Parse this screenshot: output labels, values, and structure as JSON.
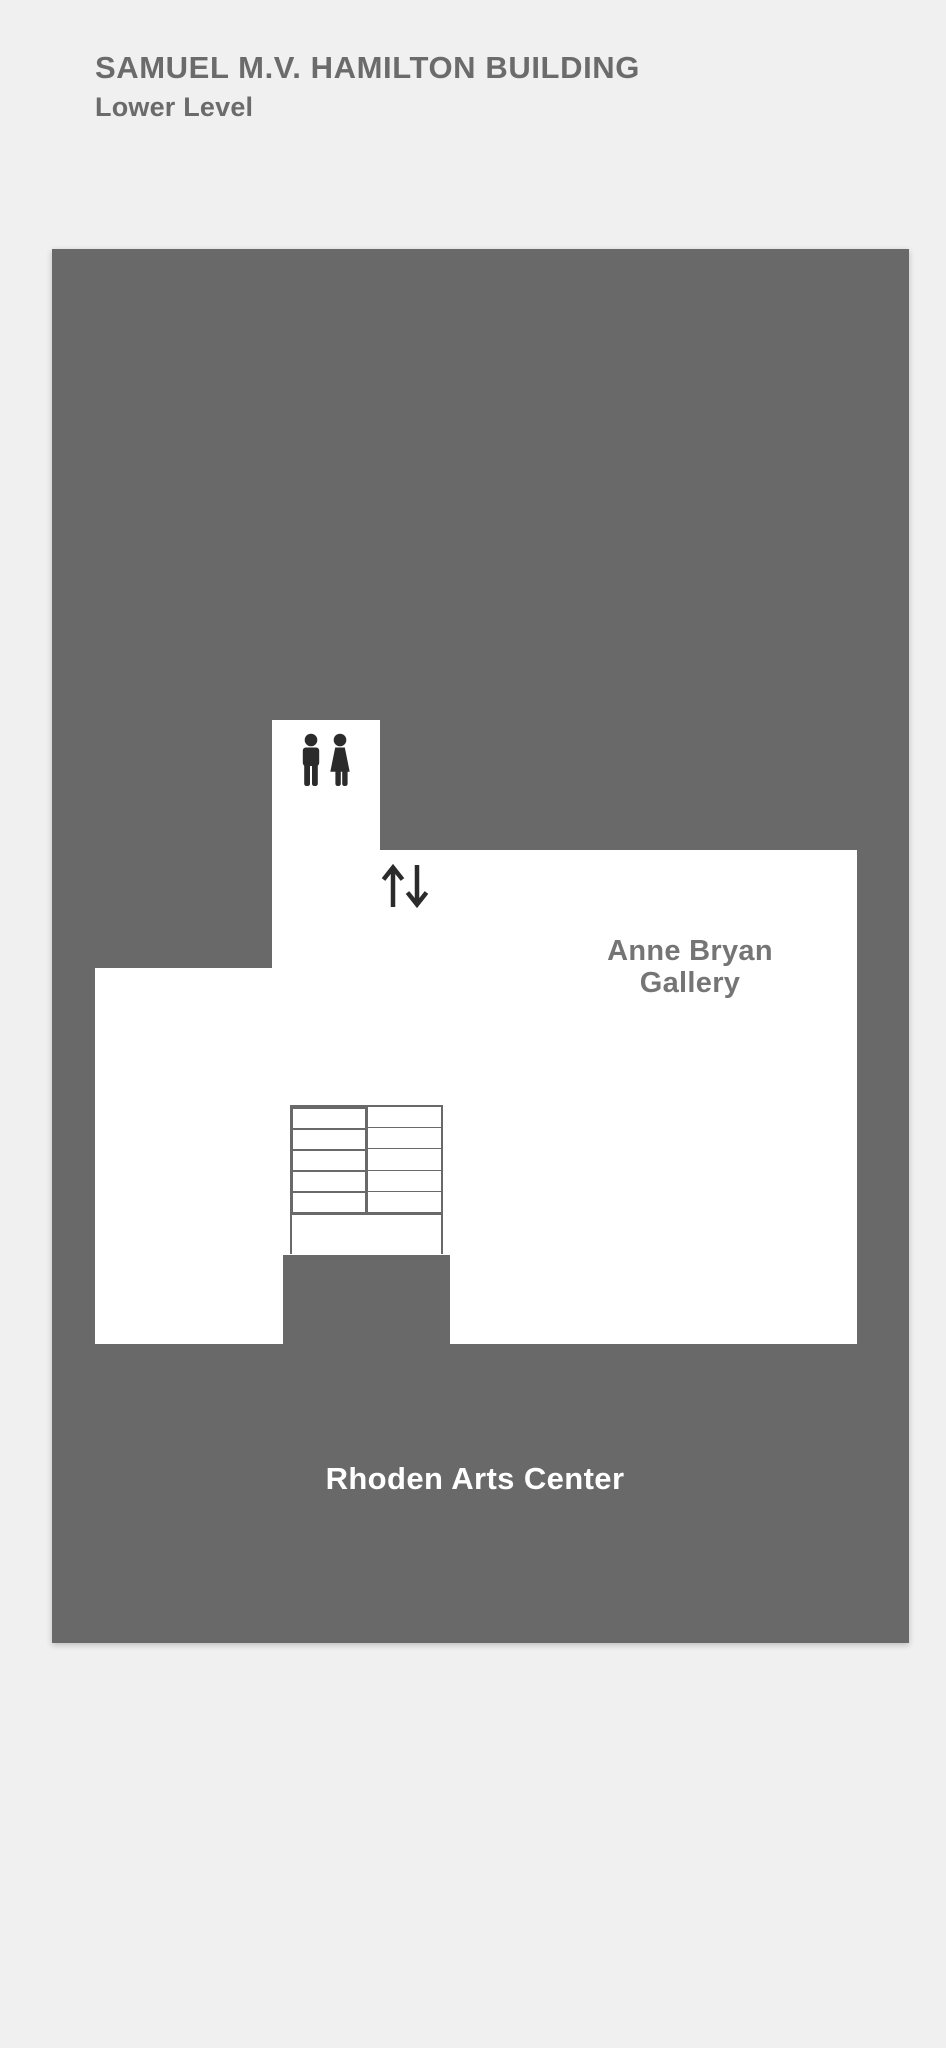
{
  "header": {
    "title": "SAMUEL M.V. HAMILTON BUILDING",
    "subtitle": "Lower Level"
  },
  "floorplan": {
    "labels": {
      "gallery_line1": "Anne Bryan",
      "gallery_line2": "Gallery",
      "arts_center": "Rhoden Arts Center"
    },
    "icons": {
      "restroom": "restroom-men-women-icon",
      "elevator": "elevator-up-down-arrows-icon"
    },
    "stairs": {
      "flights": 2,
      "treads_per_flight": 5
    }
  },
  "colors": {
    "page_bg": "#f0f0f0",
    "building": "#696969",
    "floor": "#ffffff",
    "heading_text": "#6b6b6b",
    "gallery_label": "#757575",
    "arts_center_label": "#ffffff",
    "icon": "#2b2b2b",
    "stair_line": "#696969"
  }
}
